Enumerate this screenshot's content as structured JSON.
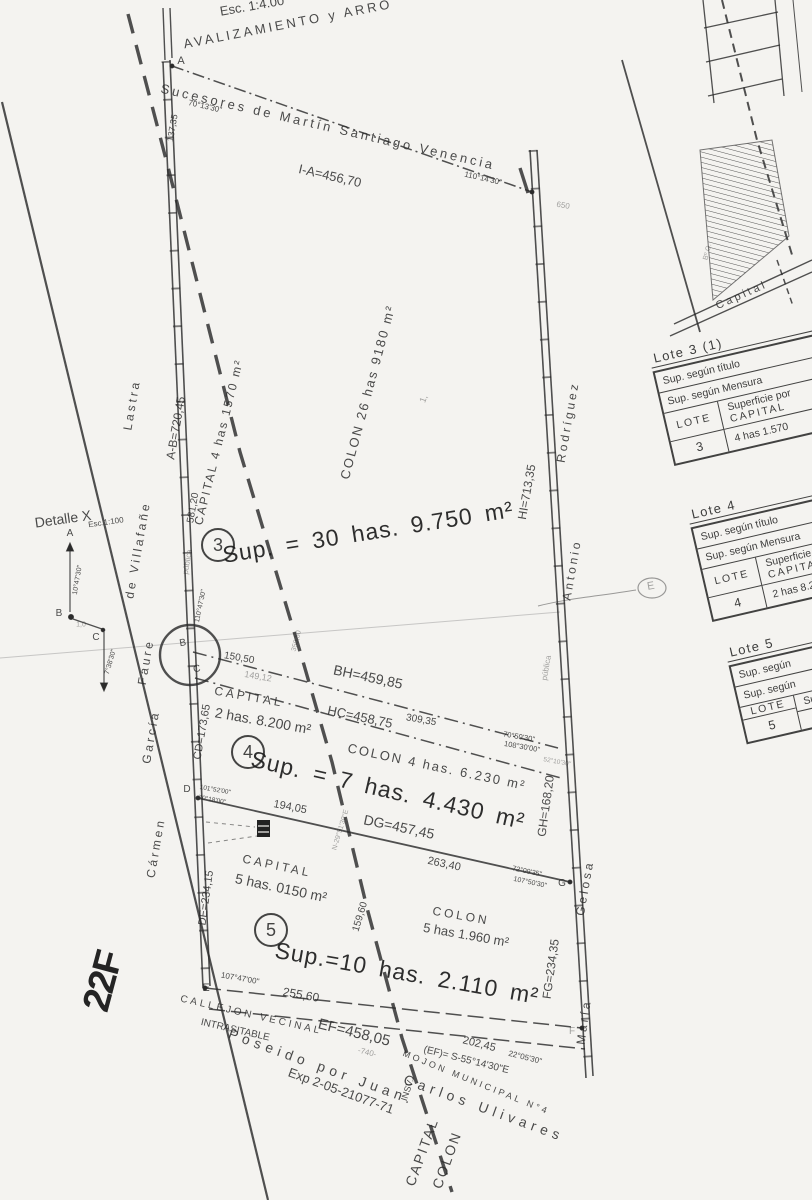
{
  "colors": {
    "paper": "#f4f3f0",
    "ink": "#2c2c2c"
  },
  "tables": {
    "t3": {
      "title": "Lote 3 (1)",
      "row1": "Sup. según título",
      "row2": "Sup. según Mensura",
      "lote": "LOTE",
      "hdr1": "Superficie por",
      "hdr2": "CAPITAL",
      "num": "3",
      "val": "4 has 1.570"
    },
    "t4": {
      "title": "Lote 4",
      "row1": "Sup. según título",
      "row2": "Sup. según Mensura",
      "lote": "LOTE",
      "hdr1": "Superficie por",
      "hdr2": "CAPITAL",
      "num": "4",
      "val": "2 has 8.200"
    },
    "t5": {
      "title": "Lote 5",
      "row1": "Sup. según",
      "row2": "Sup. según",
      "lote": "LOTE",
      "hdr1": "Superficie",
      "hdr2": "",
      "num": "5",
      "val": ""
    }
  },
  "annotations": [
    {
      "n": "scale-note",
      "t": "Esc. 1:4.00",
      "x": 252,
      "y": 6,
      "r": -10,
      "s": 13
    },
    {
      "n": "title-fragment",
      "t": "AVALIZAMIENTO y ARRO",
      "x": 288,
      "y": 24,
      "r": -11,
      "s": 13,
      "c": "spaced"
    },
    {
      "n": "north-owner-label",
      "t": "Sucesores de Martín Santiago Venencia",
      "x": 328,
      "y": 127,
      "r": 13,
      "s": 13,
      "c": "spaced"
    },
    {
      "n": "line-ia-length",
      "t": "I-A=456,70",
      "x": 330,
      "y": 176,
      "r": 13,
      "s": 13
    },
    {
      "n": "bearing-a",
      "t": "70°13'30\"",
      "x": 205,
      "y": 107,
      "r": 13,
      "s": 8
    },
    {
      "n": "bearing-i",
      "t": "110°14'30\"",
      "x": 483,
      "y": 179,
      "r": 13,
      "s": 8
    },
    {
      "n": "faint-mark-650",
      "t": "650",
      "x": 563,
      "y": 206,
      "r": 10,
      "s": 8,
      "c": "faint"
    },
    {
      "n": "dist-137-35",
      "t": "137,35",
      "x": 173,
      "y": 128,
      "r": -80,
      "s": 9
    },
    {
      "n": "point-a",
      "t": "A",
      "x": 181,
      "y": 62,
      "r": 0,
      "s": 11
    },
    {
      "n": "point-b",
      "t": "B",
      "x": 183,
      "y": 644,
      "r": -10,
      "s": 10
    },
    {
      "n": "point-c",
      "t": "C",
      "x": 197,
      "y": 670,
      "r": -10,
      "s": 10
    },
    {
      "n": "point-d",
      "t": "D",
      "x": 187,
      "y": 790,
      "r": 0,
      "s": 10
    },
    {
      "n": "point-e",
      "t": "E",
      "x": 206,
      "y": 989,
      "r": 0,
      "s": 11
    },
    {
      "n": "point-g",
      "t": "G",
      "x": 562,
      "y": 884,
      "r": 0,
      "s": 10
    },
    {
      "n": "point-f",
      "t": "F",
      "x": 572,
      "y": 1032,
      "r": 0,
      "s": 10,
      "c": "faint"
    },
    {
      "n": "neighbor-lastra",
      "t": "Lastra",
      "x": 132,
      "y": 405,
      "r": -80,
      "s": 12,
      "c": "spaced"
    },
    {
      "n": "neighbor-de-villafane",
      "t": "de Villafañe",
      "x": 138,
      "y": 550,
      "r": -80,
      "s": 12,
      "c": "spaced"
    },
    {
      "n": "neighbor-faure",
      "t": "Faure",
      "x": 146,
      "y": 662,
      "r": -80,
      "s": 12,
      "c": "spaced"
    },
    {
      "n": "neighbor-garcia",
      "t": "García",
      "x": 151,
      "y": 737,
      "r": -80,
      "s": 12,
      "c": "spaced"
    },
    {
      "n": "neighbor-carmen",
      "t": "Cármen",
      "x": 156,
      "y": 848,
      "r": -80,
      "s": 12,
      "c": "spaced"
    },
    {
      "n": "line-ab-length",
      "t": "A-B=720,45",
      "x": 176,
      "y": 428,
      "r": -80,
      "s": 12
    },
    {
      "n": "dist-581-20",
      "t": "581,20",
      "x": 194,
      "y": 508,
      "r": -80,
      "s": 10
    },
    {
      "n": "calle-publica-west",
      "t": "pública",
      "x": 188,
      "y": 562,
      "r": -80,
      "s": 8,
      "c": "faint"
    },
    {
      "n": "bearing-b",
      "t": "110°47'30\"",
      "x": 201,
      "y": 606,
      "r": -78,
      "s": 7
    },
    {
      "n": "line-cd-length",
      "t": "CD=173,65",
      "x": 203,
      "y": 732,
      "r": -80,
      "s": 11
    },
    {
      "n": "line-de-length",
      "t": "DE=234,15",
      "x": 207,
      "y": 898,
      "r": -82,
      "s": 11
    },
    {
      "n": "lot3-capital-area",
      "t": "CAPITAL 4 has 1570 m²",
      "x": 219,
      "y": 442,
      "r": -76,
      "s": 12,
      "c": "vlabel"
    },
    {
      "n": "lot3-colon-area",
      "t": "COLON 26 has 9180 m²",
      "x": 368,
      "y": 392,
      "r": -75,
      "s": 13,
      "c": "vlabel"
    },
    {
      "n": "lot3-number",
      "t": "3",
      "x": 218,
      "y": 545,
      "r": 0,
      "s": 18,
      "c": "circled"
    },
    {
      "n": "lot3-total-area",
      "t": "Sup. = 30 has. 9.750 m²",
      "x": 368,
      "y": 532,
      "r": -9,
      "s": 23,
      "c": "big"
    },
    {
      "n": "mark-1",
      "t": "1,",
      "x": 424,
      "y": 399,
      "r": -70,
      "s": 9,
      "c": "faint"
    },
    {
      "n": "dist-150-50",
      "t": "150,50",
      "x": 239,
      "y": 659,
      "r": 10,
      "s": 10
    },
    {
      "n": "dist-149-12",
      "t": "149,12",
      "x": 258,
      "y": 677,
      "r": 10,
      "s": 9,
      "c": "faint"
    },
    {
      "n": "line-bh-length",
      "t": "BH=459,85",
      "x": 368,
      "y": 677,
      "r": 12,
      "s": 14
    },
    {
      "n": "line-hc-length",
      "t": "HC=458,75",
      "x": 360,
      "y": 717,
      "r": 12,
      "s": 13
    },
    {
      "n": "dist-309-35",
      "t": "309,35",
      "x": 421,
      "y": 721,
      "r": 10,
      "s": 10
    },
    {
      "n": "dist-350-50",
      "t": "350,50",
      "x": 297,
      "y": 641,
      "r": -75,
      "s": 7,
      "c": "faint"
    },
    {
      "n": "bearing-h-1",
      "t": "70°50'30\"",
      "x": 519,
      "y": 737,
      "r": 10,
      "s": 7.5
    },
    {
      "n": "bearing-h-2",
      "t": "108°30'00\"",
      "x": 522,
      "y": 747,
      "r": 10,
      "s": 7.5
    },
    {
      "n": "bearing-h-3",
      "t": "52°10'30\"",
      "x": 557,
      "y": 763,
      "r": 10,
      "s": 6.5,
      "c": "faint"
    },
    {
      "n": "lot4-number",
      "t": "4",
      "x": 248,
      "y": 752,
      "r": 0,
      "s": 18,
      "c": "circled"
    },
    {
      "n": "lot4-capital-label",
      "t": "CAPITAL",
      "x": 249,
      "y": 697,
      "r": 10,
      "s": 12,
      "c": "spaced"
    },
    {
      "n": "lot4-capital-area",
      "t": "2 has. 8.200 m²",
      "x": 263,
      "y": 721,
      "r": 10,
      "s": 14
    },
    {
      "n": "lot4-colon-area",
      "t": "COLON 4 has. 6.230 m²",
      "x": 437,
      "y": 767,
      "r": 12,
      "s": 13,
      "c": "vlabel"
    },
    {
      "n": "lot4-total-area",
      "t": "Sup. = 7 has. 4.430 m²",
      "x": 388,
      "y": 790,
      "r": 13,
      "s": 23,
      "c": "big"
    },
    {
      "n": "line-dg-length",
      "t": "DG=457,45",
      "x": 399,
      "y": 827,
      "r": 12,
      "s": 14
    },
    {
      "n": "dist-194-05",
      "t": "194,05",
      "x": 290,
      "y": 808,
      "r": 11,
      "s": 11
    },
    {
      "n": "bearing-d-1",
      "t": "101°52'00\"",
      "x": 215,
      "y": 791,
      "r": 10,
      "s": 6.5
    },
    {
      "n": "bearing-d-2",
      "t": "70°18'00\"",
      "x": 212,
      "y": 801,
      "r": 10,
      "s": 6.5
    },
    {
      "n": "divide-line-bearing",
      "t": "N-29°51'30\"E",
      "x": 341,
      "y": 830,
      "r": -73,
      "s": 7,
      "c": "faint"
    },
    {
      "n": "lot5-number",
      "t": "5",
      "x": 271,
      "y": 930,
      "r": 0,
      "s": 18,
      "c": "circled"
    },
    {
      "n": "lot5-capital-label",
      "t": "CAPITAL",
      "x": 277,
      "y": 866,
      "r": 12,
      "s": 12,
      "c": "spaced"
    },
    {
      "n": "lot5-capital-area",
      "t": "5 has. 0150 m²",
      "x": 281,
      "y": 888,
      "r": 12,
      "s": 14
    },
    {
      "n": "lot5-colon-label",
      "t": "COLON",
      "x": 461,
      "y": 916,
      "r": 10,
      "s": 12,
      "c": "spaced"
    },
    {
      "n": "lot5-colon-area",
      "t": "5 has 1.960 m²",
      "x": 466,
      "y": 935,
      "r": 10,
      "s": 13
    },
    {
      "n": "lot5-total-area",
      "t": "Sup.=10 has. 2.110 m²",
      "x": 407,
      "y": 973,
      "r": 10,
      "s": 23,
      "c": "big"
    },
    {
      "n": "dist-263-40",
      "t": "263,40",
      "x": 444,
      "y": 865,
      "r": 12,
      "s": 11
    },
    {
      "n": "bearing-g-1",
      "t": "72°09'35\"",
      "x": 527,
      "y": 872,
      "r": 12,
      "s": 7
    },
    {
      "n": "bearing-g-2",
      "t": "107°50'30\"",
      "x": 530,
      "y": 883,
      "r": 12,
      "s": 7
    },
    {
      "n": "dist-159-60",
      "t": "159,60",
      "x": 361,
      "y": 917,
      "r": -73,
      "s": 10
    },
    {
      "n": "bearing-e",
      "t": "107°47'00\"",
      "x": 240,
      "y": 979,
      "r": 10,
      "s": 8
    },
    {
      "n": "dist-255-60",
      "t": "255,60",
      "x": 301,
      "y": 995,
      "r": 10,
      "s": 12
    },
    {
      "n": "callejon-label-1",
      "t": "CALLEJON VECINAL",
      "x": 251,
      "y": 1016,
      "r": 13,
      "s": 10,
      "c": "spaced"
    },
    {
      "n": "callejon-label-2",
      "t": "INTRASITABLE",
      "x": 235,
      "y": 1031,
      "r": 13,
      "s": 10
    },
    {
      "n": "line-ef-length",
      "t": "EF=458,05",
      "x": 354,
      "y": 1033,
      "r": 14,
      "s": 15
    },
    {
      "n": "dist-740",
      "t": "-740-",
      "x": 367,
      "y": 1053,
      "r": 14,
      "s": 8,
      "c": "faint"
    },
    {
      "n": "line-ef-bearing",
      "t": "(EF)= S-55°14'30\"E",
      "x": 466,
      "y": 1061,
      "r": 14,
      "s": 10
    },
    {
      "n": "dist-202-45",
      "t": "202,45",
      "x": 479,
      "y": 1045,
      "r": 14,
      "s": 11
    },
    {
      "n": "bearing-f",
      "t": "22°05'30\"",
      "x": 525,
      "y": 1058,
      "r": 14,
      "s": 8
    },
    {
      "n": "mojon-municipal",
      "t": "MOJON MUNICIPAL N°4",
      "x": 476,
      "y": 1083,
      "r": 22,
      "s": 9,
      "c": "spaced"
    },
    {
      "n": "possessor-line-1",
      "t": "Poseido por Juan.",
      "x": 322,
      "y": 1067,
      "r": 20,
      "s": 14,
      "c": "wide"
    },
    {
      "n": "possessor-line-2",
      "t": "Carlos Ulivares",
      "x": 484,
      "y": 1108,
      "r": 20,
      "s": 14,
      "c": "wide"
    },
    {
      "n": "expediente",
      "t": "Exp 2-05-21077-71",
      "x": 341,
      "y": 1091,
      "r": 20,
      "s": 13
    },
    {
      "n": "boundary-capital",
      "t": "CAPITAL",
      "x": 422,
      "y": 1152,
      "r": -70,
      "s": 14,
      "c": "vlabel"
    },
    {
      "n": "boundary-colon",
      "t": "COLON",
      "x": 447,
      "y": 1160,
      "r": -70,
      "s": 14,
      "c": "vlabel"
    },
    {
      "n": "boundary-insv",
      "t": "INSV.",
      "x": 408,
      "y": 1090,
      "r": -72,
      "s": 9
    },
    {
      "n": "neighbor-rodriguez",
      "t": "Rodríguez",
      "x": 568,
      "y": 422,
      "r": -80,
      "s": 12,
      "c": "spaced"
    },
    {
      "n": "line-hi-length",
      "t": "HI=713,35",
      "x": 527,
      "y": 492,
      "r": -80,
      "s": 12
    },
    {
      "n": "neighbor-antonio",
      "t": "Antonio",
      "x": 572,
      "y": 570,
      "r": -80,
      "s": 12,
      "c": "spaced"
    },
    {
      "n": "calle-publica-east",
      "t": "pública",
      "x": 547,
      "y": 668,
      "r": -80,
      "s": 8,
      "c": "faint"
    },
    {
      "n": "line-gh-length",
      "t": "GH=168,20",
      "x": 546,
      "y": 806,
      "r": -82,
      "s": 12
    },
    {
      "n": "neighbor-gelosa",
      "t": "Gelosa",
      "x": 585,
      "y": 888,
      "r": -80,
      "s": 12,
      "c": "spaced"
    },
    {
      "n": "line-fg-length",
      "t": "FG=234,35",
      "x": 551,
      "y": 969,
      "r": -82,
      "s": 12
    },
    {
      "n": "neighbor-maria",
      "t": "María",
      "x": 584,
      "y": 1022,
      "r": -82,
      "s": 12,
      "c": "spaced"
    },
    {
      "n": "detail-title",
      "t": "Detalle X",
      "x": 63,
      "y": 519,
      "r": -8,
      "s": 14
    },
    {
      "n": "detail-scale",
      "t": "Esc.1:100",
      "x": 106,
      "y": 523,
      "r": -8,
      "s": 8
    },
    {
      "n": "detail-point-a",
      "t": "A",
      "x": 70,
      "y": 534,
      "r": 0,
      "s": 10
    },
    {
      "n": "detail-point-b",
      "t": "B",
      "x": 59,
      "y": 614,
      "r": 0,
      "s": 10
    },
    {
      "n": "detail-point-c",
      "t": "C",
      "x": 96,
      "y": 638,
      "r": 0,
      "s": 10
    },
    {
      "n": "detail-dist-1-0",
      "t": "1,0",
      "x": 81,
      "y": 625,
      "r": 0,
      "s": 7,
      "c": "faint"
    },
    {
      "n": "detail-bearing-ab",
      "t": "10°47'30\"",
      "x": 78,
      "y": 580,
      "r": -80,
      "s": 7
    },
    {
      "n": "detail-bearing-bc",
      "t": "7°38'30\"",
      "x": 111,
      "y": 662,
      "r": -74,
      "s": 7
    },
    {
      "n": "inset-capital-label",
      "t": "Capital",
      "x": 742,
      "y": 296,
      "r": -24,
      "s": 11,
      "c": "spaced"
    },
    {
      "n": "inset-barrio-label",
      "t": "Bº O.",
      "x": 708,
      "y": 252,
      "r": -75,
      "s": 7,
      "c": "faint"
    },
    {
      "n": "handwritten-stamp",
      "t": "22F",
      "x": 104,
      "y": 982,
      "r": -75,
      "s": 38,
      "c": "stamp"
    },
    {
      "n": "stamp-e-letter",
      "t": "E",
      "x": 651,
      "y": 587,
      "r": -10,
      "s": 11,
      "c": "faint"
    }
  ]
}
